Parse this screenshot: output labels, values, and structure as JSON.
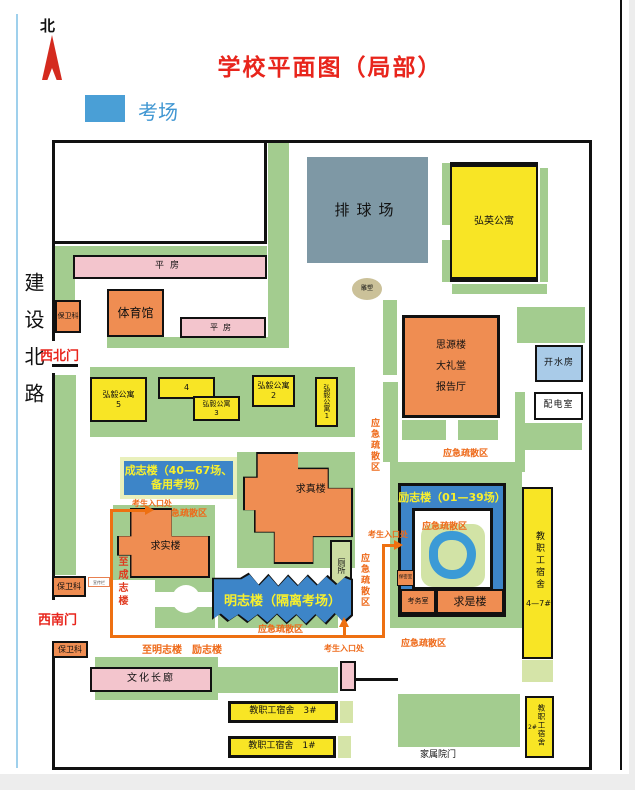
{
  "header": {
    "compass": "北",
    "title": "学校平面图（局部）",
    "legend_label": "考场",
    "legend_color": "#4a9fd6"
  },
  "road": "建设北路",
  "gates": {
    "northwest": "西北门",
    "southwest": "西南门",
    "family": "家属院门"
  },
  "repeat": {
    "evac_zone": "应急疏散区",
    "security_office": "保卫科",
    "flat_house": "平房",
    "exam_entrance": "考生入口处"
  },
  "buildings": {
    "volleyball": "排球场",
    "hongying_apt": "弘英公寓",
    "sculpture": "雕塑",
    "gym": "体育馆",
    "siyuan": "思源楼\n大礼堂\n报告厅",
    "hot_water": "开水房",
    "power_room": "配电室",
    "hongyi_5": "弘毅公寓\n5",
    "hongyi_4": "4",
    "hongyi_3": "弘毅公寓\n3",
    "hongyi_2": "弘毅公寓\n2",
    "hongyi_1": "弘毅公寓1",
    "chengzhi": "成志楼（40—67场、\n备用考场）",
    "qiushi_west": "求实楼",
    "qiuzhen": "求真楼",
    "toilet": "厕所",
    "mingzhi": "明志楼（隔离考场）",
    "lizhi": "励志楼（01—39场）",
    "baomi": "保密室",
    "kaowu": "考务室",
    "qiushi_east": "求是楼",
    "staff_dorm": "教职工宿舍",
    "staff_dorm_47_num": "4—7#",
    "staff_dorm_3": "教职工宿舍　3#",
    "staff_dorm_1": "教职工宿舍　1#",
    "staff_dorm_2_num": "2#",
    "culture_corridor": "文化长廊",
    "bulletin": "宣传栏"
  },
  "routes": {
    "to_chengzhi": "至成志楼",
    "to_mingzhi_lizhi": "至明志楼　励志楼"
  },
  "colors": {
    "exam_blue": "#3d85c8",
    "lawn_green": "#a3cc8f",
    "building_orange": "#ef8d52",
    "building_yellow": "#f8e525",
    "building_pink": "#f3c5cd",
    "court_gray": "#7e98a5",
    "route_orange": "#ee7011",
    "gate_red": "#e8251c"
  }
}
